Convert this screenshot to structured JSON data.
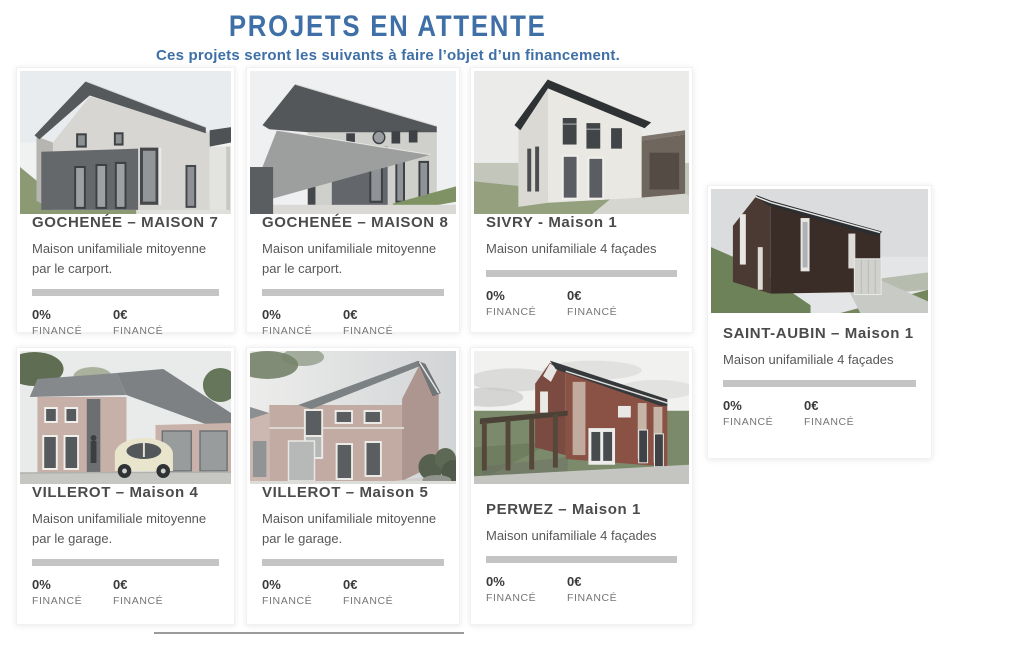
{
  "header": {
    "title": "PROJETS EN ATTENTE",
    "subtitle": "Ces projets seront les suivants à faire l’objet d’un financement."
  },
  "colors": {
    "accent_blue": "#3e6fa6",
    "card_title_gray": "#4b4b4b",
    "progress_track_gray": "#c4c4c4"
  },
  "projects": [
    {
      "title": "GOCHENÉE – MAISON 7",
      "description": "Maison unifamiliale mitoyenne par le carport.",
      "percent_funded": "0%",
      "percent_label": "FINANCÉ",
      "amount_funded": "0€",
      "amount_label": "FINANCÉ",
      "progress": 0
    },
    {
      "title": "GOCHENÉE – MAISON 8",
      "description": "Maison unifamiliale mitoyenne par le carport.",
      "percent_funded": "0%",
      "percent_label": "FINANCÉ",
      "amount_funded": "0€",
      "amount_label": "FINANCÉ",
      "progress": 0
    },
    {
      "title": "SIVRY - Maison 1",
      "description": "Maison unifamiliale 4 façades",
      "percent_funded": "0%",
      "percent_label": "FINANCÉ",
      "amount_funded": "0€",
      "amount_label": "FINANCÉ",
      "progress": 0
    },
    {
      "title": "SAINT-AUBIN – Maison 1",
      "description": "Maison unifamiliale 4 façades",
      "percent_funded": "0%",
      "percent_label": "FINANCÉ",
      "amount_funded": "0€",
      "amount_label": "FINANCÉ",
      "progress": 0
    },
    {
      "title": "VILLEROT – Maison 4",
      "description": "Maison unifamiliale mitoyenne par le garage.",
      "percent_funded": "0%",
      "percent_label": "FINANCÉ",
      "amount_funded": "0€",
      "amount_label": "FINANCÉ",
      "progress": 0
    },
    {
      "title": "VILLEROT – Maison 5",
      "description": "Maison unifamiliale mitoyenne par le garage.",
      "percent_funded": "0%",
      "percent_label": "FINANCÉ",
      "amount_funded": "0€",
      "amount_label": "FINANCÉ",
      "progress": 0
    },
    {
      "title": "PERWEZ – Maison 1",
      "description": "Maison unifamiliale 4 façades",
      "percent_funded": "0%",
      "percent_label": "FINANCÉ",
      "amount_funded": "0€",
      "amount_label": "FINANCÉ",
      "progress": 0
    }
  ]
}
